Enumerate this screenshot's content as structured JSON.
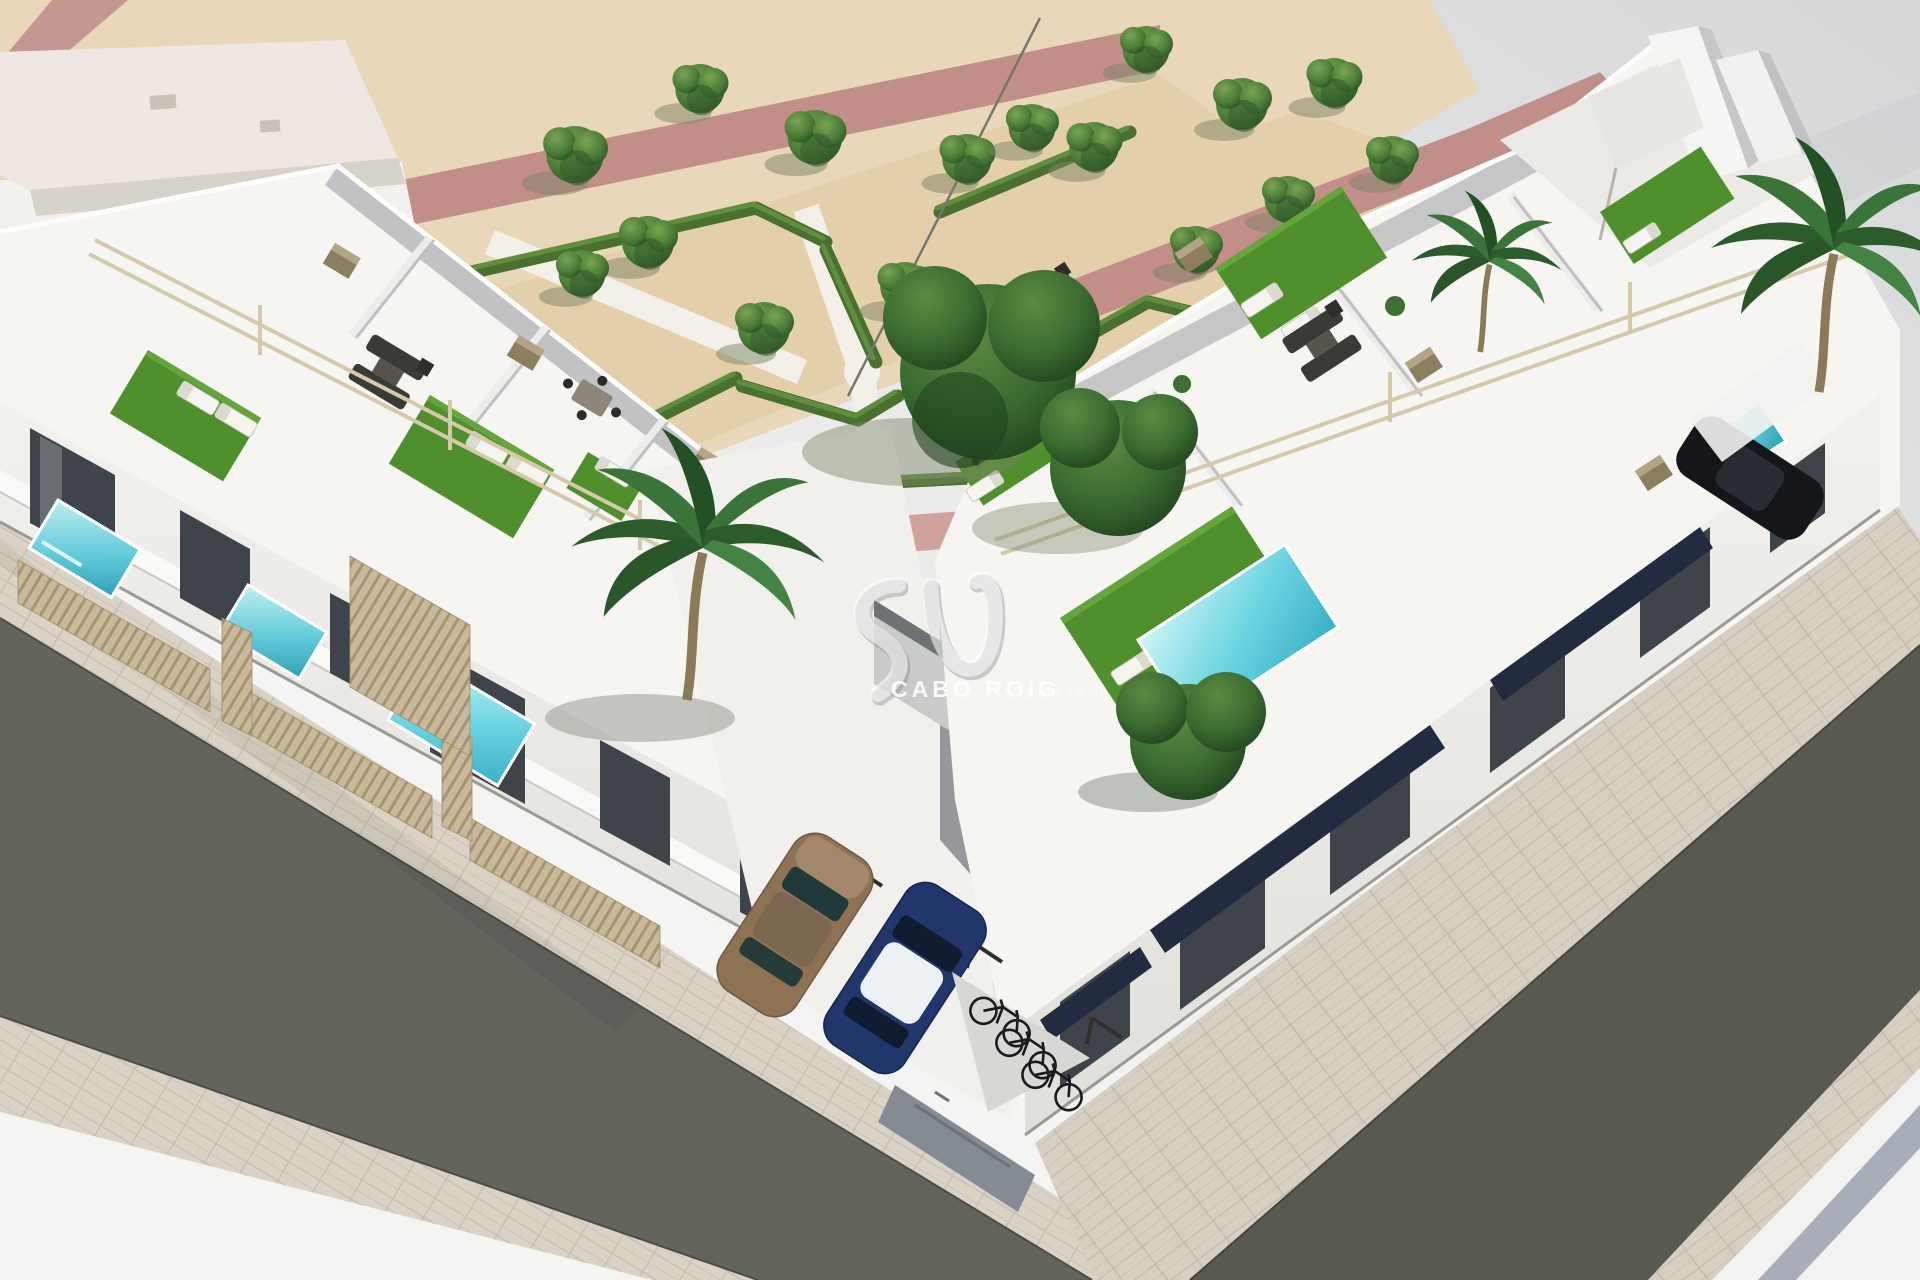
{
  "watermark": {
    "logo": "sv-swoosh-icon",
    "brand": "CABO ROIG",
    "tagline": "Desde 1970"
  },
  "scene": {
    "type": "aerial-3d-architectural-render",
    "subject": "New-build development of white modern townhouses with rooftop terraces, private plunge pools, a landscaped parterre park and two corner streets",
    "time_of_day": "bright daylight",
    "objects": {
      "building_rows": 2,
      "rooftop_terraces_with_turf": 7,
      "private_pools": 5,
      "parked_cars": 3,
      "bicycles": 3,
      "palm_trees": 3,
      "park_trees_small": 18,
      "park_trees_large": 2,
      "street_trees": 1,
      "sun_loungers": 11,
      "pergolas": true,
      "bike_shelter": true,
      "parking_bays": true
    },
    "palette": {
      "sand": "#e8d7b8",
      "gravel": "#e3d0ab",
      "walkway_pink": "#c28e89",
      "hedge_green": "#4a7031",
      "turf_green": "#4f8f2c",
      "tree_green": "#44753a",
      "building_white": "#f6f5f2",
      "wall_shadow": "#bdbdc0",
      "glass_dark": "#3e444a",
      "wood_beige": "#c3b297",
      "pool_turquoise": "#55c8d8",
      "asphalt_gray": "#61625a",
      "paver_beige": "#d8d1c4",
      "car_bronze": "#8b7254",
      "car_blue": "#21366b",
      "watermark_white": "#ffffff"
    }
  }
}
